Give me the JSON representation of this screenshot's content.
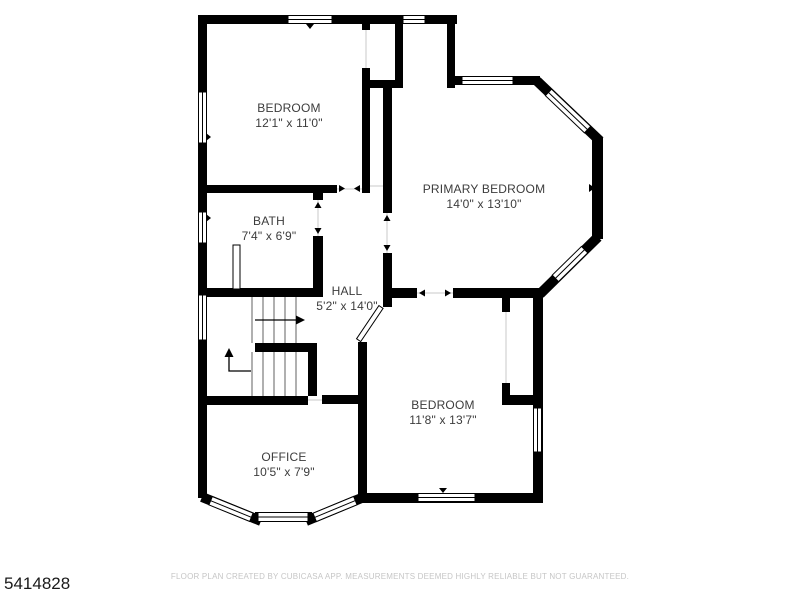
{
  "plan_id": "5414828",
  "footer_disclaimer": "FLOOR PLAN CREATED BY CUBICASA APP. MEASUREMENTS DEEMED HIGHLY RELIABLE BUT NOT GUARANTEED.",
  "rooms": [
    {
      "name": "BEDROOM",
      "dimensions": "12'1\" x 11'0\""
    },
    {
      "name": "PRIMARY BEDROOM",
      "dimensions": "14'0\" x 13'10\""
    },
    {
      "name": "BATH",
      "dimensions": "7'4\" x 6'9\""
    },
    {
      "name": "HALL",
      "dimensions": "5'2\" x 14'0\""
    },
    {
      "name": "BEDROOM",
      "dimensions": "11'8\" x 13'7\""
    },
    {
      "name": "OFFICE",
      "dimensions": "10'5\" x 7'9\""
    }
  ],
  "colors": {
    "wall": "#000000",
    "room_label": "#3c3c3c",
    "footer_text": "#c6c6c6",
    "plan_id_text": "#1a1a1a"
  }
}
